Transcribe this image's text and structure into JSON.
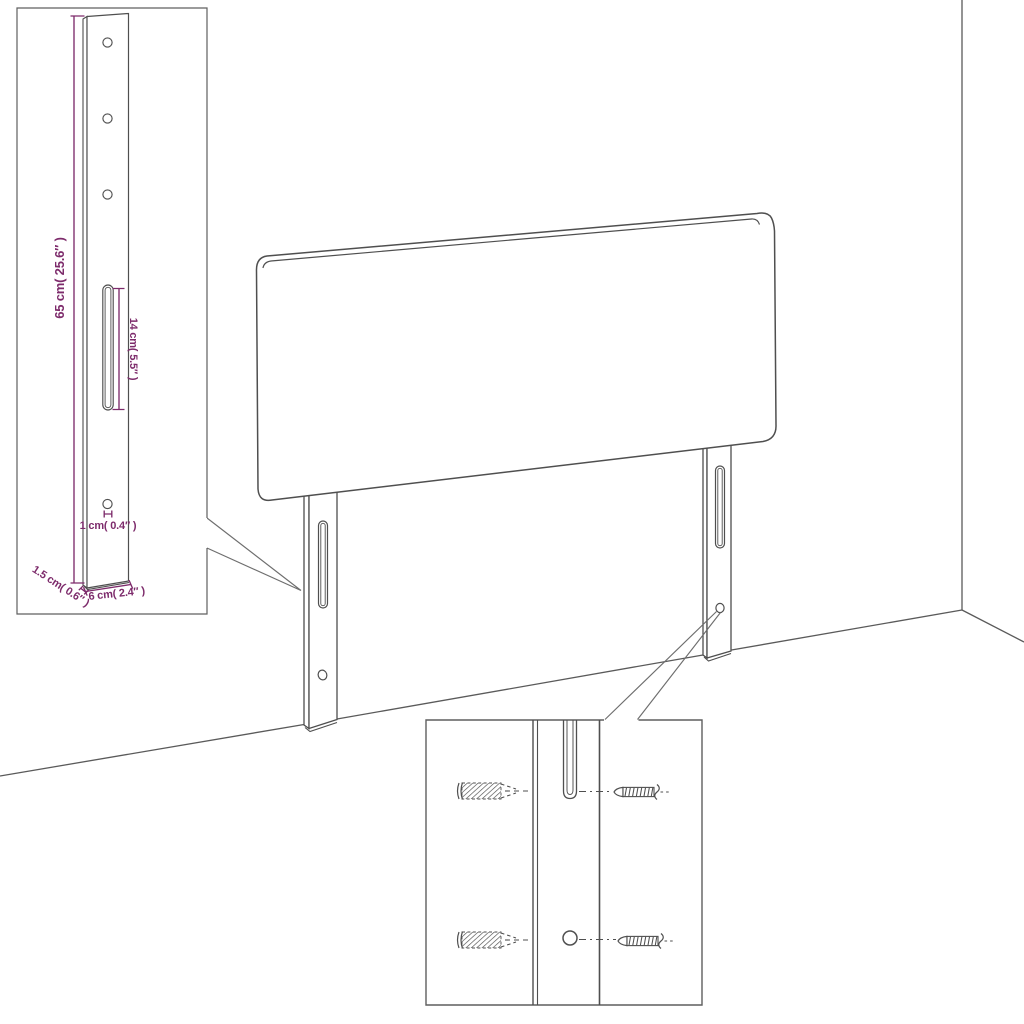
{
  "page": {
    "background": "#ffffff"
  },
  "colors": {
    "line": "#4f4f4f",
    "dimension": "#7d2b6b",
    "inset_border": "#5f5f5f"
  },
  "product": {
    "view": "headboard-with-mounting-legs-in-room-corner",
    "insets": {
      "bracket_detail": {
        "dimensions": {
          "height": "65 cm( 25.6″ )",
          "slot_length": "14 cm( 5.5″ )",
          "hole_diameter": "1 cm( 0.4″ )",
          "thickness": "1.5 cm( 0.6″ )",
          "width": "6 cm( 2.4″ )"
        }
      },
      "mounting_detail": {
        "parts": [
          "wall-plug",
          "screw",
          "leg-slot",
          "leg-hole"
        ]
      }
    }
  }
}
